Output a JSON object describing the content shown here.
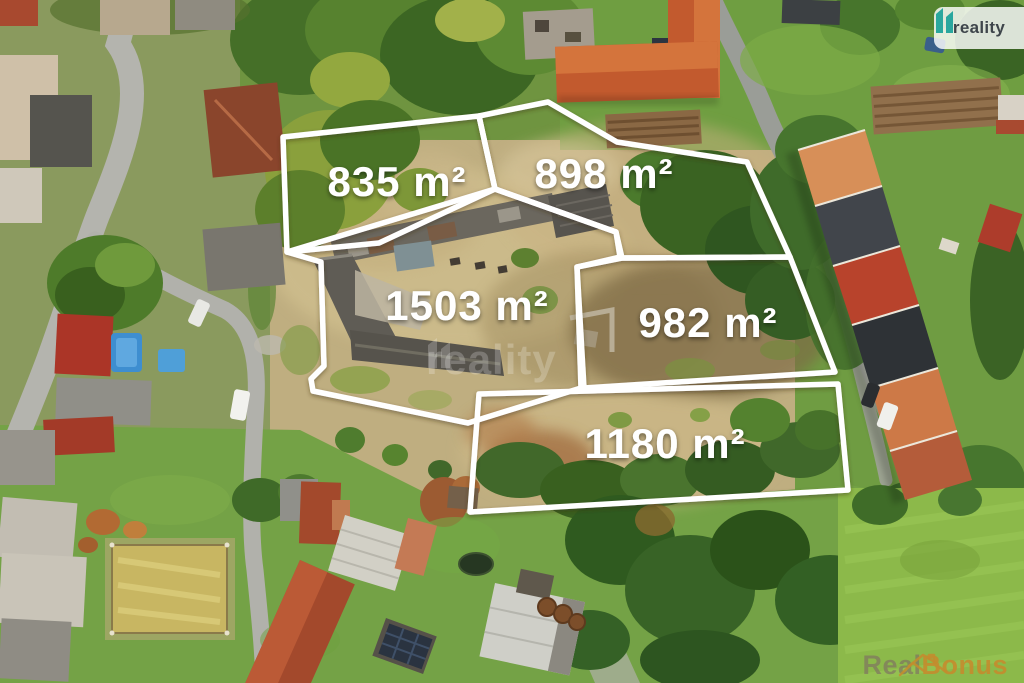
{
  "plots": [
    {
      "id": "plot-835",
      "area_m2": 835,
      "label": "835 m²"
    },
    {
      "id": "plot-898",
      "area_m2": 898,
      "label": "898 m²"
    },
    {
      "id": "plot-1503",
      "area_m2": 1503,
      "label": "1503 m²"
    },
    {
      "id": "plot-982",
      "area_m2": 982,
      "label": "982 m²"
    },
    {
      "id": "plot-1180",
      "area_m2": 1180,
      "label": "1180 m²"
    }
  ],
  "branding": {
    "logo": {
      "text": "reality",
      "accent_color": "#2aa79e"
    },
    "center_watermark": {
      "text": "reality"
    },
    "corner_watermark": {
      "text_primary": "Real",
      "text_secondary": "Bonus",
      "accent_color": "#c28a2e"
    }
  },
  "style": {
    "boundary_color": "#ffffff",
    "label_color": "#ffffff"
  }
}
